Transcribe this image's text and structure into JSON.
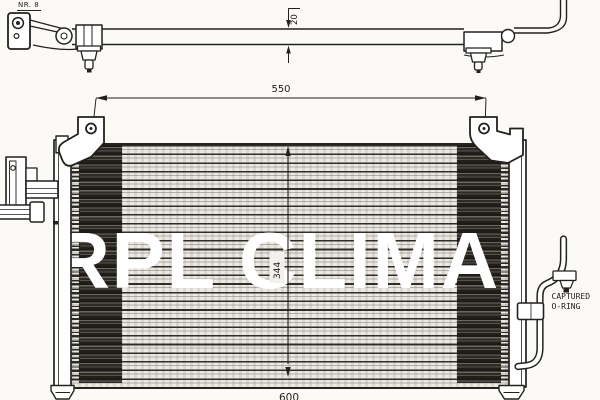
{
  "colors": {
    "bg": "#fbfaf7",
    "ink": "#23211e",
    "watermark": "#ffffff"
  },
  "annotations": {
    "part_label": "NR. 8",
    "captured_oring": {
      "line1": "CAPTURED",
      "line2": "O-RING"
    }
  },
  "dimensions": {
    "bracket_depth": "20",
    "mounting_span": "550",
    "core_height": "344",
    "overall_width": "600"
  },
  "watermark": {
    "text": "RPL CLIMA"
  }
}
